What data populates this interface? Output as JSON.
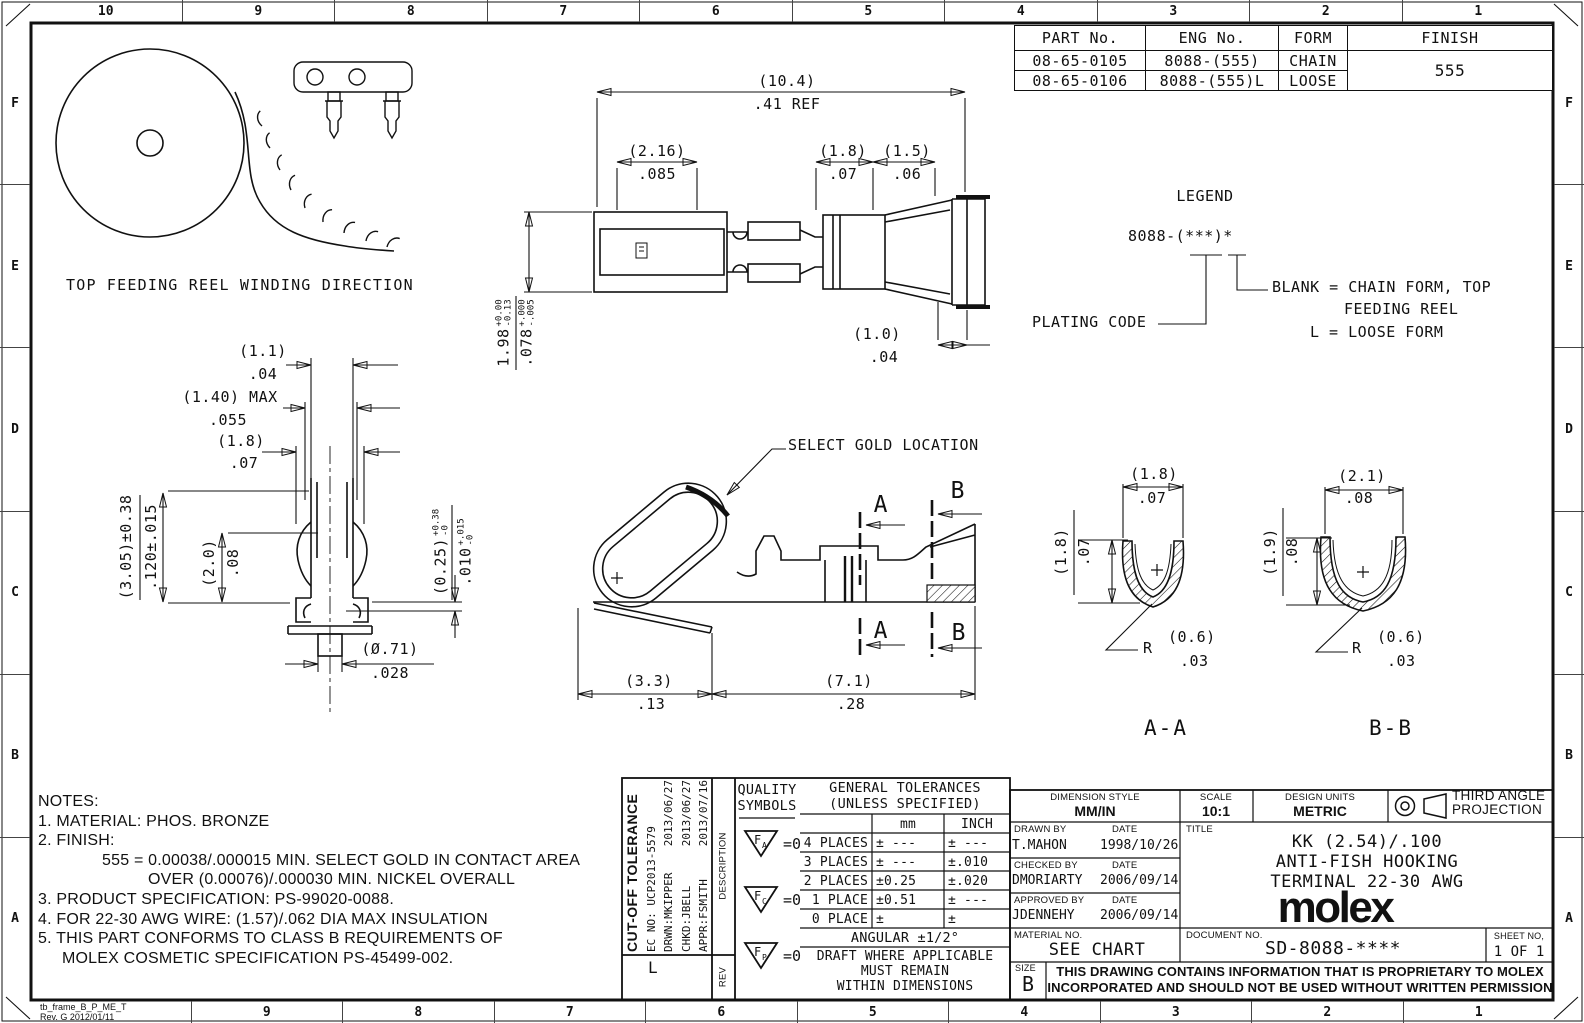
{
  "zones": {
    "top": [
      "10",
      "9",
      "8",
      "7",
      "6",
      "5",
      "4",
      "3",
      "2",
      "1"
    ],
    "bottom": [
      "9",
      "8",
      "7",
      "6",
      "5",
      "4",
      "3",
      "2",
      "1"
    ],
    "left": [
      "F",
      "E",
      "D",
      "C",
      "B",
      "A"
    ],
    "right": [
      "F",
      "E",
      "D",
      "C",
      "B",
      "A"
    ],
    "frame_note_line1": "tb_frame_B_P_ME_T",
    "frame_note_line2": "Rev. G 2012/01/11"
  },
  "part_table": {
    "headers": [
      "PART No.",
      "ENG No.",
      "FORM",
      "FINISH"
    ],
    "rows": [
      {
        "part": "08-65-0105",
        "eng": "8088-(555)",
        "form": "CHAIN"
      },
      {
        "part": "08-65-0106",
        "eng": "8088-(555)L",
        "form": "LOOSE"
      }
    ],
    "finish": "555"
  },
  "legend": {
    "title": "LEGEND",
    "code": "8088-(***)*",
    "plating_label": "PLATING CODE",
    "blank_line1": "BLANK = CHAIN FORM, TOP",
    "blank_line2": "FEEDING REEL",
    "loose_line": "L = LOOSE FORM"
  },
  "reel": {
    "caption": "TOP FEEDING REEL WINDING DIRECTION"
  },
  "dims": {
    "plan": {
      "overall_mm": "(10.4)",
      "overall_in": ".41 REF",
      "barrel_mm": "(2.16)",
      "barrel_in": ".085",
      "d18_mm": "(1.8)",
      "d18_in": ".07",
      "d15_mm": "(1.5)",
      "d15_in": ".06",
      "d10_mm": "(1.0)",
      "d10_in": ".04",
      "h_mm": "1.98",
      "h_mm_top": "+0.00",
      "h_mm_bot": "-0.13",
      "h_in": ".078",
      "h_in_top": "+.000",
      "h_in_bot": "-.005"
    },
    "front": {
      "d11_mm": "(1.1)",
      "d11_in": ".04",
      "d140_mm": "(1.40) MAX",
      "d140_in": ".055",
      "d18_mm": "(1.8)",
      "d18_in": ".07",
      "d305_mm": "(3.05)±0.38",
      "d305_in": ".120±.015",
      "d20_mm": "(2.0)",
      "d20_in": ".08",
      "d025_mm": "(0.25)",
      "d025_mm_top": "+0.38",
      "d025_mm_bot": "-0",
      "d025_in": ".010",
      "d025_in_top": "+.015",
      "d025_in_bot": "-0",
      "d071_mm": "(Ø.71)",
      "d071_in": ".028"
    },
    "side": {
      "callout": "SELECT GOLD LOCATION",
      "sec_a": "A",
      "sec_b": "B",
      "d33_mm": "(3.3)",
      "d33_in": ".13",
      "d71_mm": "(7.1)",
      "d71_in": ".28"
    },
    "section_aa": {
      "label": "A-A",
      "w_mm": "(1.8)",
      "w_in": ".07",
      "h_mm": "(1.8)",
      "h_in": ".07",
      "r_prefix": "R",
      "r_mm": "(0.6)",
      "r_in": ".03"
    },
    "section_bb": {
      "label": "B-B",
      "w_mm": "(2.1)",
      "w_in": ".08",
      "h_mm": "(1.9)",
      "h_in": ".08",
      "r_prefix": "R",
      "r_mm": "(0.6)",
      "r_in": ".03"
    }
  },
  "notes": {
    "header": "NOTES:",
    "n1": "1. MATERIAL: PHOS. BRONZE",
    "n2": "2. FINISH:",
    "n2a": "555 = 0.00038/.000015 MIN. SELECT GOLD IN CONTACT AREA",
    "n2b": "OVER (0.00076)/.000030 MIN. NICKEL OVERALL",
    "n3": "3. PRODUCT SPECIFICATION: PS-99020-0088.",
    "n4": "4. FOR 22-30 AWG WIRE: (1.57)/.062 DIA MAX INSULATION",
    "n5": "5. THIS PART CONFORMS TO CLASS B REQUIREMENTS OF",
    "n5b": "MOLEX COSMETIC SPECIFICATION PS-45499-002."
  },
  "title_block": {
    "revision": {
      "change": "CUT-OFF TOLERANCE",
      "ec_no": "EC NO: UCP2013-5579",
      "drwn": "DRWN:MKIPPER",
      "drwn_date": "2013/06/27",
      "chkd": "CHKD:JBELL",
      "chkd_date": "2013/06/27",
      "appr": "APPR:FSMITH",
      "appr_date": "2013/07/16",
      "rev": "L",
      "description_label": "DESCRIPTION",
      "rev_label": "REV"
    },
    "quality": {
      "line1": "QUALITY",
      "line2": "SYMBOLS",
      "sym_letter": "F",
      "sym1_sub": "A",
      "sym2_sub": "C",
      "sym3_sub": "P",
      "sym_eq": "=0"
    },
    "tolerances": {
      "title1": "GENERAL TOLERANCES",
      "title2": "(UNLESS SPECIFIED)",
      "col_mm": "mm",
      "col_inch": "INCH",
      "r4_label": "4 PLACES",
      "r4_mm": "± ---",
      "r4_in": "± ---",
      "r3_label": "3 PLACES",
      "r3_mm": "± ---",
      "r3_in": "±.010",
      "r2_label": "2 PLACES",
      "r2_mm": "±0.25",
      "r2_in": "±.020",
      "r1_label": "1 PLACE",
      "r1_mm": "±0.51",
      "r1_in": "± ---",
      "r0_label": "0 PLACE",
      "r0_mm": "±",
      "r0_in": "±",
      "angular": "ANGULAR ±1/2°",
      "draft1": "DRAFT WHERE APPLICABLE",
      "draft2": "MUST REMAIN",
      "draft3": "WITHIN DIMENSIONS"
    },
    "info": {
      "dim_style_label": "DIMENSION STYLE",
      "dim_style": "MM/IN",
      "scale_label": "SCALE",
      "scale": "10:1",
      "units_label": "DESIGN UNITS",
      "units": "METRIC",
      "proj1": "THIRD ANGLE",
      "proj2": "PROJECTION",
      "drawn_label": "DRAWN BY",
      "date_label": "DATE",
      "drawn": "T.MAHON",
      "drawn_date": "1998/10/26",
      "checked_label": "CHECKED BY",
      "checked": "DMORIARTY",
      "checked_date": "2006/09/14",
      "approved_label": "APPROVED BY",
      "approved": "JDENNEHY",
      "approved_date": "2006/09/14",
      "title_label": "TITLE",
      "title1": "KK (2.54)/.100",
      "title2": "ANTI-FISH HOOKING",
      "title3": "TERMINAL 22-30 AWG",
      "logo": "molex",
      "material_label": "MATERIAL NO.",
      "material": "SEE CHART",
      "document_label": "DOCUMENT NO.",
      "document": "SD-8088-****",
      "sheet_label": "SHEET NO,",
      "sheet": "1 OF 1",
      "size_label": "SIZE",
      "size": "B",
      "prop1": "THIS DRAWING CONTAINS INFORMATION THAT IS PROPRIETARY TO MOLEX",
      "prop2": "INCORPORATED AND SHOULD NOT BE USED WITHOUT WRITTEN PERMISSION"
    }
  }
}
